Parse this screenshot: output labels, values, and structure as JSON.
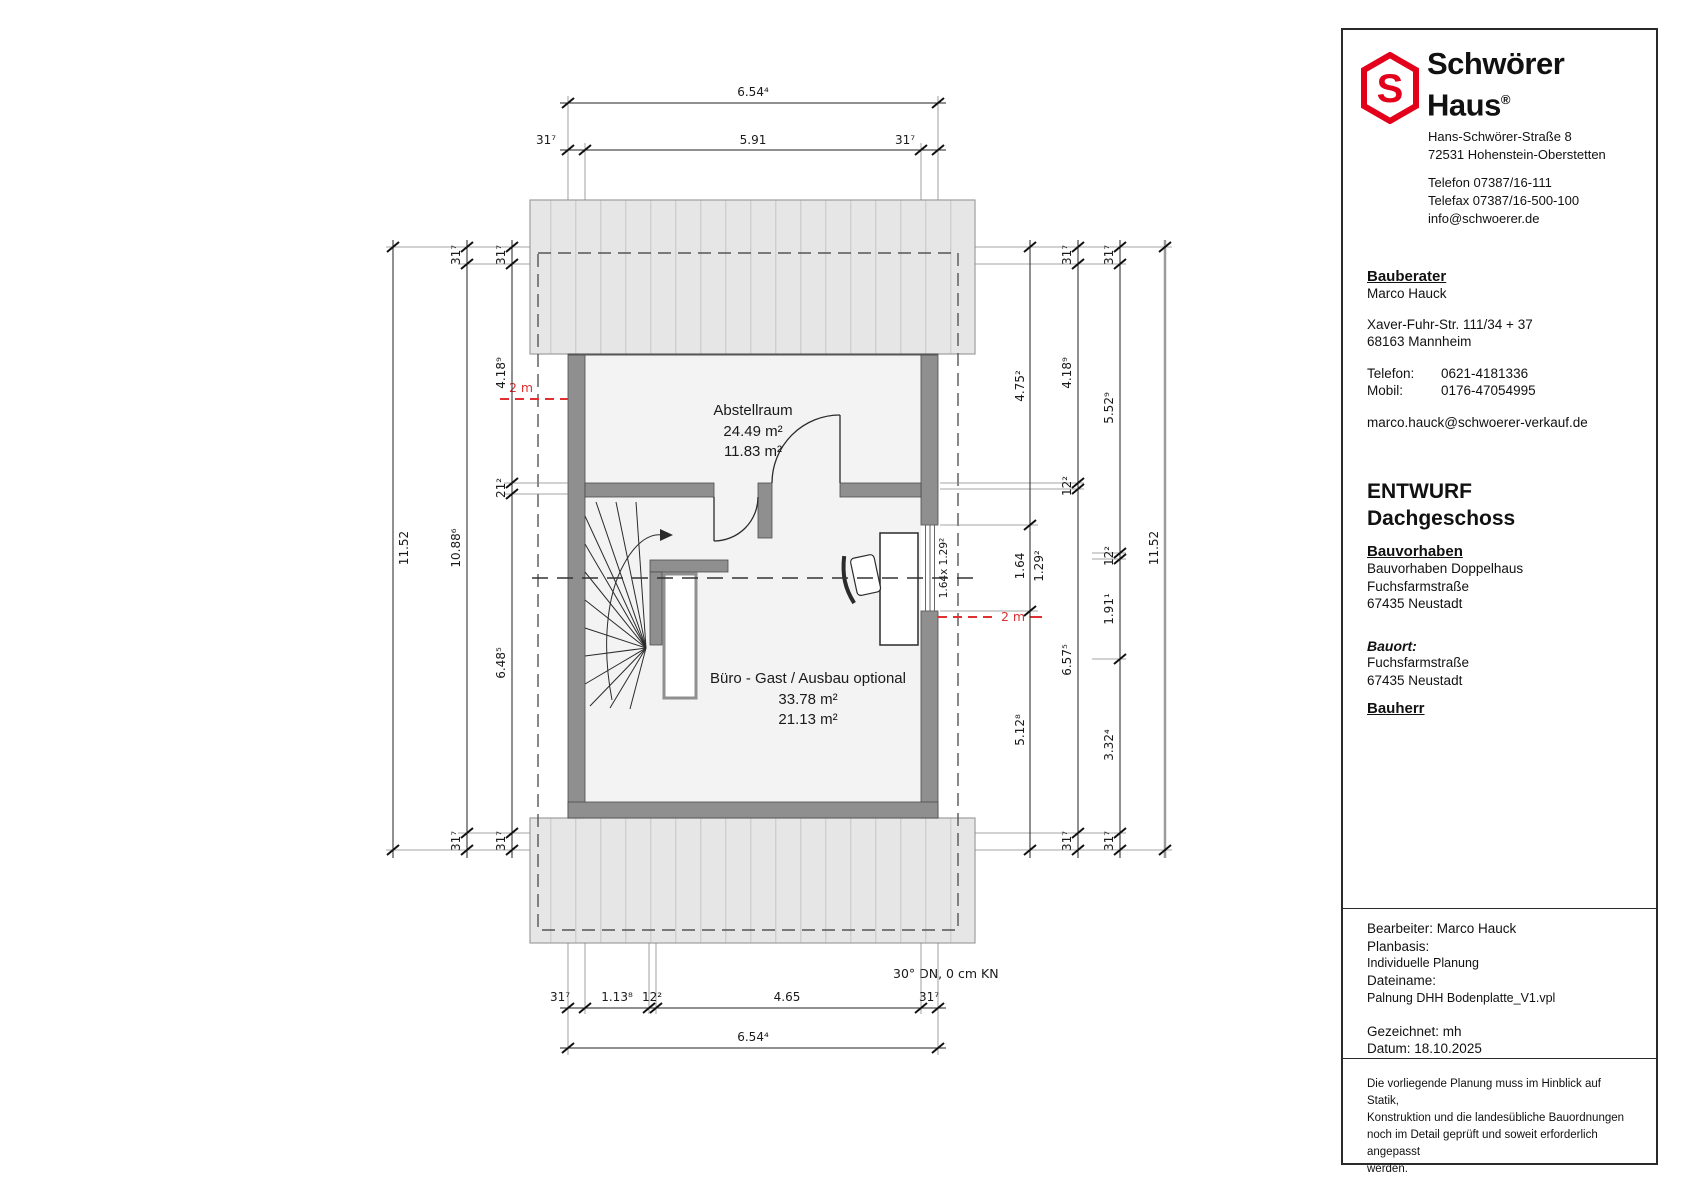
{
  "plan": {
    "rooms": [
      {
        "name": "Abstellraum",
        "area_gross": "24.49 m²",
        "area_net": "11.83 m²"
      },
      {
        "name": "Büro - Gast / Ausbau optional",
        "area_gross": "33.78 m²",
        "area_net": "21.13 m²"
      }
    ],
    "window_label": "1.64x 1.29²",
    "headroom_label": "2 m",
    "roof_note": "30° DN, 0 cm KN",
    "dims": {
      "top_total": "6.54⁴",
      "top_row": [
        "31⁷",
        "5.91",
        "31⁷"
      ],
      "bottom_row": [
        "31⁷",
        "1.13⁸",
        "12²",
        "4.65",
        "31⁷"
      ],
      "bottom_total": "6.54⁴",
      "left_total": "11.52",
      "left_mid": [
        "31⁷",
        "10.88⁶",
        "31⁷"
      ],
      "left_inner": [
        "31⁷",
        "4.18⁹",
        "21²",
        "6.48⁵",
        "31⁷"
      ],
      "right_inner": [
        "4.75²",
        "1.64",
        "1.29²",
        "5.12⁸"
      ],
      "right_mid1": [
        "31⁷",
        "4.18⁹",
        "12²",
        "6.57⁵",
        "31⁷"
      ],
      "right_mid2": [
        "31⁷",
        "5.52⁹",
        "12²",
        "1.91¹",
        "3.32⁴",
        "31⁷"
      ],
      "right_total": "11.52"
    }
  },
  "titleblock": {
    "company": {
      "name_line1": "Schwörer",
      "name_line2": "Haus",
      "registered": "®",
      "logo_letter": "S",
      "address1": "Hans-Schwörer-Straße 8",
      "address2": "72531 Hohenstein-Oberstetten",
      "phone": "Telefon 07387/16-111",
      "fax": "Telefax 07387/16-500-100",
      "email": "info@schwoerer.de"
    },
    "consultant": {
      "heading": "Bauberater",
      "name": "Marco Hauck",
      "street": "Xaver-Fuhr-Str. 111/34 + 37",
      "city": "68163 Mannheim",
      "phone_label": "Telefon:",
      "phone": "0621-4181336",
      "mobile_label": "Mobil:",
      "mobile": "0176-47054995",
      "email": "marco.hauck@schwoerer-verkauf.de"
    },
    "drawing": {
      "status": "ENTWURF",
      "floor": "Dachgeschoss"
    },
    "project": {
      "heading": "Bauvorhaben",
      "line1": "Bauvorhaben Doppelhaus",
      "line2": "Fuchsfarmstraße",
      "line3": "67435 Neustadt"
    },
    "site": {
      "heading": "Bauort:",
      "line1": "Fuchsfarmstraße",
      "line2": "67435 Neustadt"
    },
    "client": {
      "heading": "Bauherr"
    },
    "meta": {
      "editor": "Bearbeiter: Marco Hauck",
      "planbasis_label": "Planbasis:",
      "planbasis": "Individuelle Planung",
      "filename_label": "Dateiname:",
      "filename": "Palnung DHH Bodenplatte_V1.vpl",
      "drawn": "Gezeichnet: mh",
      "date": "Datum: 18.10.2025"
    },
    "disclaimer": [
      "Die vorliegende Planung muss im Hinblick auf Statik,",
      "Konstruktion und die landesübliche Bauordnungen",
      "noch im Detail geprüft und soweit erforderlich angepasst",
      "werden."
    ]
  }
}
